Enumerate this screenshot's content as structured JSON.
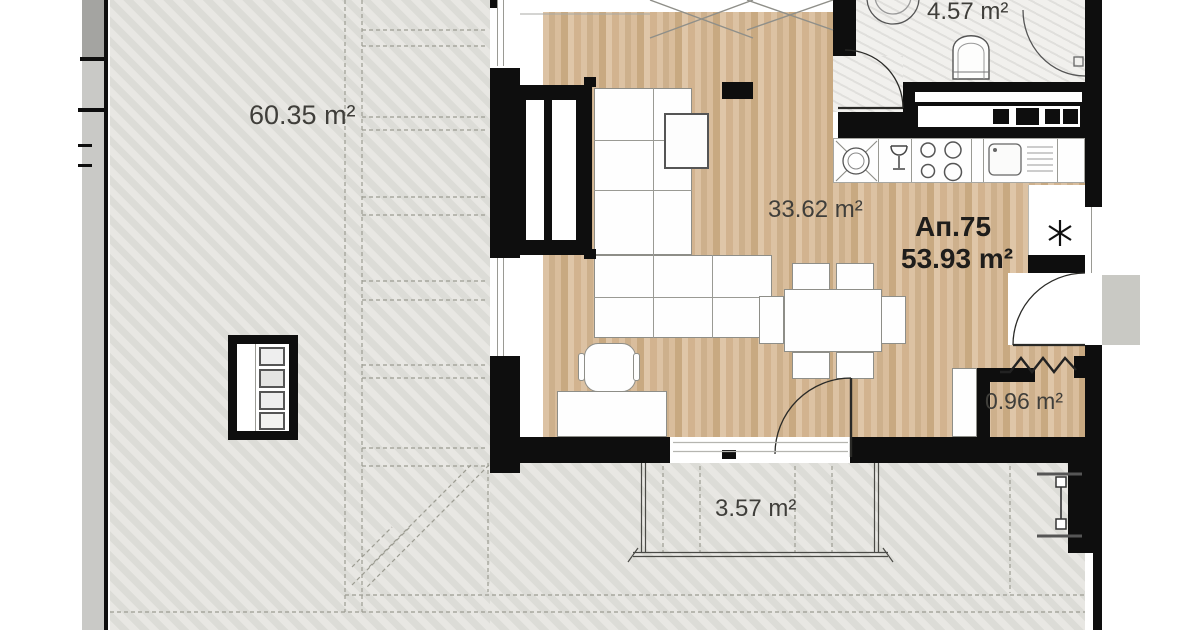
{
  "title": "Apartment floor plan",
  "labels": {
    "terrace_area": "60.35 m²",
    "bathroom_area": "4.57 m²",
    "living_area": "33.62 m²",
    "apartment_no": "Ап.75",
    "apartment_total_area": "53.93 m²",
    "closet_area": "0.96 m²",
    "balcony_area": "3.57 m²"
  },
  "icons": {
    "washing_machine": "washing-machine-icon",
    "glass": "glass-icon",
    "stove": "stove-burners-icon",
    "sink": "kitchen-sink-icon",
    "fridge": "snowflake-fridge-icon",
    "toilet": "toilet-icon",
    "shower": "shower-enclosure-icon",
    "basin": "basin-icon"
  },
  "colors": {
    "wall": "#0e0e0e",
    "wood_floor": "#d6ba97",
    "terrace_floor": "#e0dfda",
    "marble_floor": "#f1f0ed",
    "label_text": "#3f3e3a",
    "dashed_line": "#9c9c92"
  }
}
